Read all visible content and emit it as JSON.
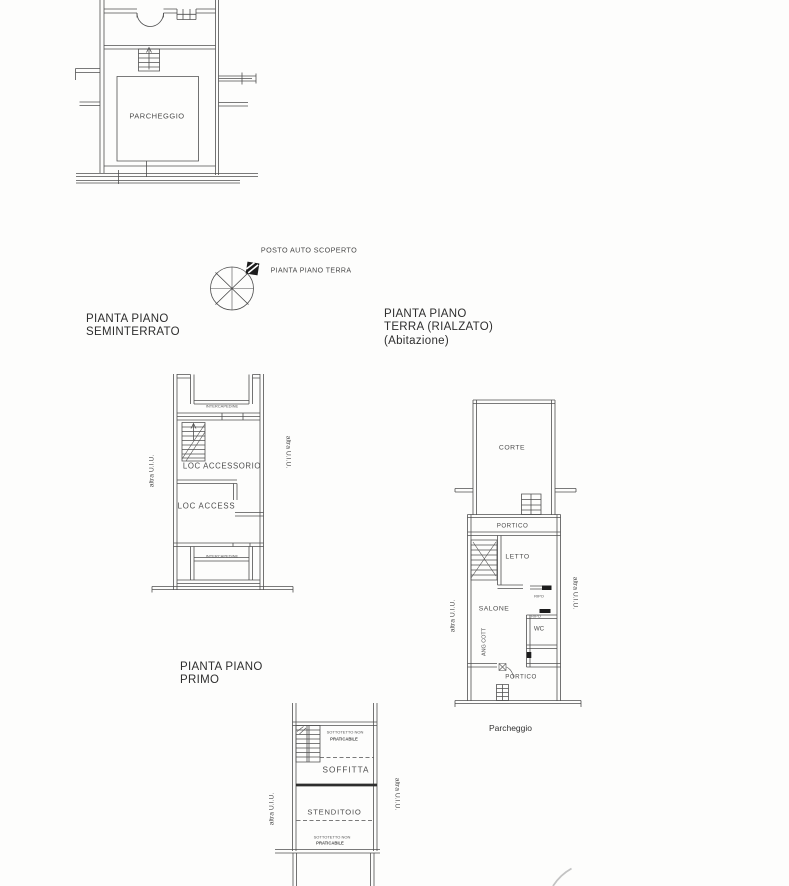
{
  "colors": {
    "paper": "#fdfdfc",
    "ink": "#4f4f4f",
    "title_text": "#2e2e2e",
    "room_text": "#4d4d4d"
  },
  "plans": {
    "garage": {
      "room": "PARCHEGGIO"
    },
    "compass_note": {
      "line1": "POSTO AUTO SCOPERTO",
      "line2": "PIANTA PIANO TERRA"
    },
    "seminterrato": {
      "title_line1": "PIANTA PIANO",
      "title_line2": "SEMINTERRATO",
      "note_top": "INTERCAPEDINE",
      "room1": "LOC ACCESSORIO",
      "room2": "LOC ACCESS",
      "note_bottom": "INTERCAPEDINE",
      "side_left": "altra U.I.U.",
      "side_right": "altra U.I.U."
    },
    "terra": {
      "title_line1": "PIANTA PIANO",
      "title_line2": "TERRA (RIALZATO)",
      "title_line3": "(Abitazione)",
      "corte": "CORTE",
      "portico_top": "PORTICO",
      "letto": "LETTO",
      "salone": "SALONE",
      "wc": "WC",
      "ang_cott": "ANG COTT",
      "ripo_1": "RIPO",
      "ripo_2": "RIPO",
      "portico_bottom": "PORTICO",
      "side_left": "altra U.I.U.",
      "side_right": "altra U.I.U.",
      "caption": "Parcheggio"
    },
    "primo": {
      "title_line1": "PIANTA PIANO",
      "title_line2": "PRIMO",
      "note_top_line1": "SOTTOTETTO NON",
      "note_top_line2": "PRATICABILE",
      "soffitta": "SOFFITTA",
      "stenditoio": "STENDITOIO",
      "note_bottom_line1": "SOTTOTETTO NON",
      "note_bottom_line2": "PRATICABILE",
      "side_left": "altra U.I.U.",
      "side_right": "altra U.I.U."
    }
  }
}
